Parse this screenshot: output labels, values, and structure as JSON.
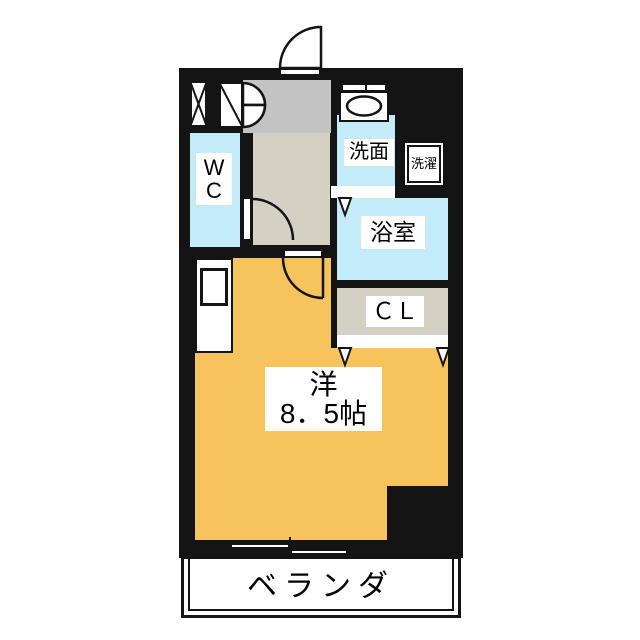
{
  "floorplan": {
    "type": "japanese-apartment-1k-floorplan",
    "rooms": {
      "wc": {
        "label": "WC",
        "lines": [
          "W",
          "C"
        ]
      },
      "washroom": {
        "label": "洗面"
      },
      "laundry": {
        "label": "洗濯"
      },
      "bathroom": {
        "label": "浴室"
      },
      "closet": {
        "label": "ＣＬ"
      },
      "main_room": {
        "name": "洋",
        "size": "8．5帖",
        "full_label": "洋 8.5帖"
      },
      "veranda": {
        "label": "ベランダ"
      }
    },
    "colors": {
      "wall_black": "#141414",
      "room_orange": "#f7c35c",
      "wet_area_blue": "#c4ebf8",
      "entrance_gray": "#c3c3c3",
      "hallway_beige": "#d4d0c4",
      "background_white": "#ffffff"
    },
    "symbols": [
      "entrance-door-swing-icon",
      "wc-door-swing-icon",
      "room-door-swing-icon",
      "pipe-space-x-icon",
      "shoe-cabinet-icon",
      "sink-basin-icon",
      "bath-door-marker-icon",
      "closet-door-markers-icon",
      "sliding-window-icon"
    ]
  }
}
